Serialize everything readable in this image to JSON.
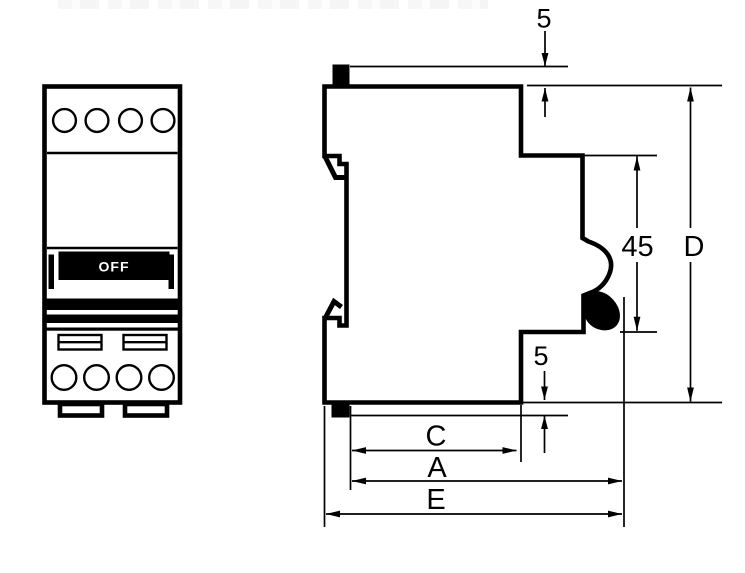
{
  "drawing": {
    "type": "technical-dimension-drawing",
    "subject": "din-rail-circuit-breaker-front-and-side-view",
    "front_view": {
      "switch_state": "OFF"
    },
    "dimension_labels": {
      "handle_top_protrusion": "5",
      "handle_bottom_protrusion": "5",
      "front_face_height": "45",
      "total_height": "D",
      "housing_depth": "C",
      "depth_without_clip": "A",
      "total_depth": "E"
    },
    "colors": {
      "ink": "#000000",
      "paper": "#ffffff"
    }
  }
}
